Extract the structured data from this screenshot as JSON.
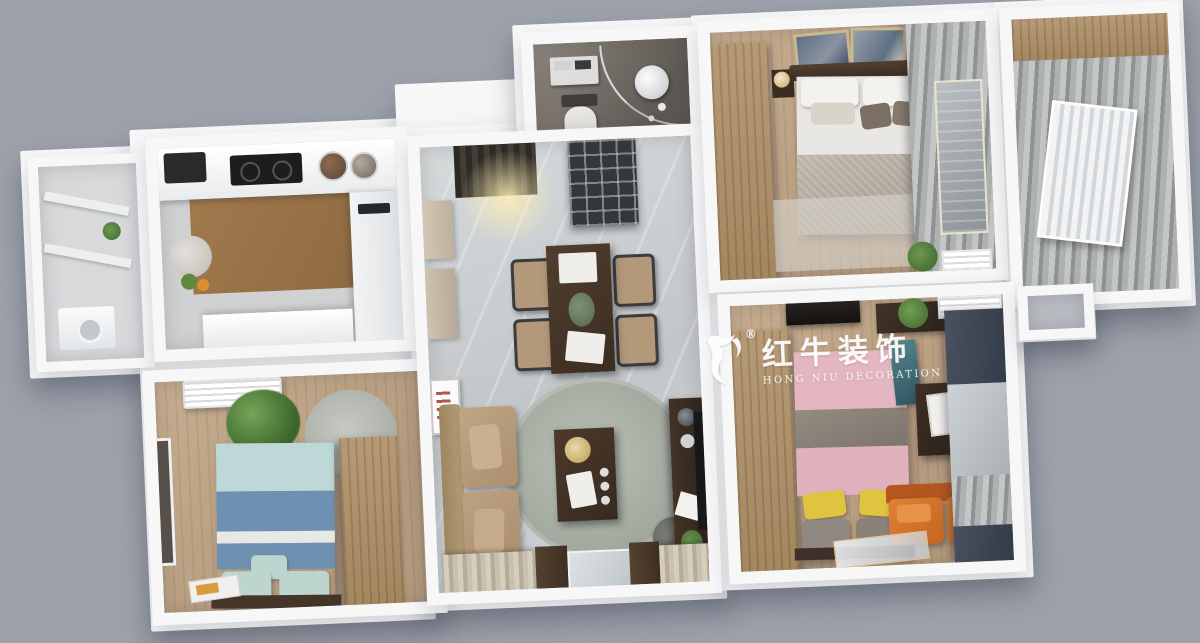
{
  "watermark": {
    "brand": "红牛装饰",
    "subtitle": "HONG NIU DECORATION",
    "registered": "®",
    "logo": "bull-logo"
  },
  "palette": {
    "background": "#9ca1ab",
    "wall": "#f7f7f8",
    "wallShade": "#e8eaed",
    "woodFloor": "#c2a98c",
    "woodFloorDark": "#a98c6d",
    "marbleFloor": "#cdd1d3",
    "bathTile": "#7a746d",
    "wardrobe": "#ab906c",
    "sofaTan": "#b3987a",
    "bedWhite": "#e9e7e3",
    "bedGray": "#b2aba1",
    "bedPink": "#e3b6c1",
    "bedBlueLight": "#bed8d8",
    "bedBlueDark": "#6f91b1",
    "pillowMint": "#bcd6cf",
    "pillowYellow": "#dec43f",
    "sofaOrange": "#d4742f",
    "curtainBeige": "#c9c0b2",
    "curtainGray": "#a7a8a6",
    "curtainDark": "#424a58",
    "rugGray": "#adb3ab",
    "darkWood": "#46372b",
    "plantGreen": "#4d7c3a",
    "watermark": "#ffffff"
  },
  "scene": {
    "type": "3d-floor-plan-render",
    "view": "top-down",
    "rooms": [
      {
        "name": "side-balcony",
        "items": [
          "window-rails",
          "washing-machine",
          "plant"
        ]
      },
      {
        "name": "kitchen",
        "items": [
          "counter",
          "cooktop",
          "pots",
          "side-table",
          "cabinets"
        ]
      },
      {
        "name": "bathroom",
        "items": [
          "toilet",
          "curved-glass-shower",
          "sink",
          "towel-shelf",
          "stool"
        ]
      },
      {
        "name": "entry-dining-living",
        "items": [
          "door-mat",
          "ceiling-light",
          "hall-cabinets",
          "glass-partition",
          "dining-table",
          "four-chairs",
          "tan-sofa",
          "round-rug",
          "coffee-table",
          "ottoman",
          "tv-console",
          "tv",
          "wall-art",
          "window-curtains"
        ]
      },
      {
        "name": "master-bedroom",
        "items": [
          "wardrobe",
          "double-bed",
          "two-art-frames",
          "nightstands",
          "lamps",
          "rug",
          "curtains",
          "plant",
          "ac-unit"
        ]
      },
      {
        "name": "right-balcony",
        "items": [
          "cabinet",
          "curtains",
          "radiator"
        ]
      },
      {
        "name": "blue-bedroom",
        "items": [
          "ac-unit",
          "plant",
          "round-rug",
          "blue-striped-bed",
          "mint-pillows",
          "wardrobe",
          "window",
          "magazine"
        ]
      },
      {
        "name": "pink-bedroom",
        "items": [
          "tv-panel",
          "planter-shelf",
          "ac-unit",
          "wardrobe",
          "pink-bed",
          "yellow-pillows",
          "teal-art",
          "desk",
          "orange-loveseat",
          "navy-curtains",
          "floor-glass-sheet"
        ]
      }
    ]
  }
}
